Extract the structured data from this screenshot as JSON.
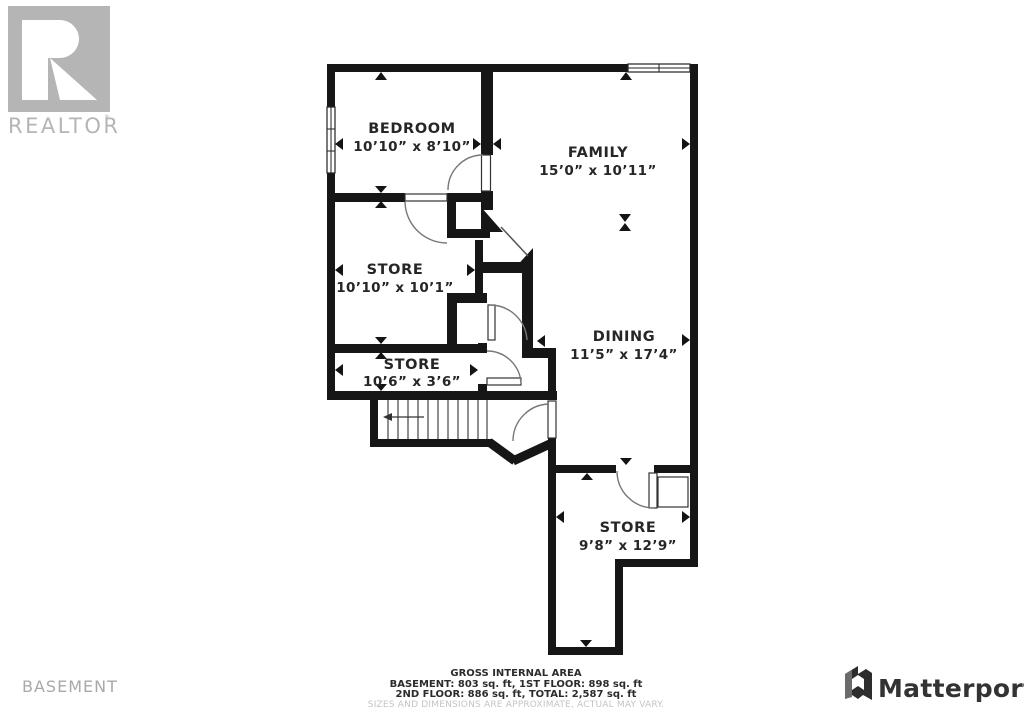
{
  "branding": {
    "realtor_logo_text": "REALTOR",
    "realtor_registered": "®",
    "matterport_text": "Matterport"
  },
  "floor_label": "BASEMENT",
  "rooms": [
    {
      "name": "BEDROOM",
      "dims": "10’10” x 8’10”"
    },
    {
      "name": "FAMILY",
      "dims": "15’0” x 10’11”"
    },
    {
      "name": "STORE",
      "dims": "10’10” x 10’1”"
    },
    {
      "name": "DINING",
      "dims": "11’5” x 17’4”"
    },
    {
      "name": "STORE",
      "dims": "10’6” x 3’6”"
    },
    {
      "name": "STORE",
      "dims": "9’8” x 12’9”"
    }
  ],
  "footer": {
    "line1": "GROSS INTERNAL AREA",
    "line2": "BASEMENT: 803 sq. ft, 1ST FLOOR: 898 sq. ft",
    "line3": "2ND FLOOR: 886 sq. ft, TOTAL: 2,587 sq. ft",
    "disclaimer": "SIZES AND DIMENSIONS ARE APPROXIMATE, ACTUAL MAY VARY."
  },
  "colors": {
    "wall": "#161616",
    "label": "#262626",
    "logo_gray": "#b5b5b5",
    "matterport": "#333333"
  }
}
